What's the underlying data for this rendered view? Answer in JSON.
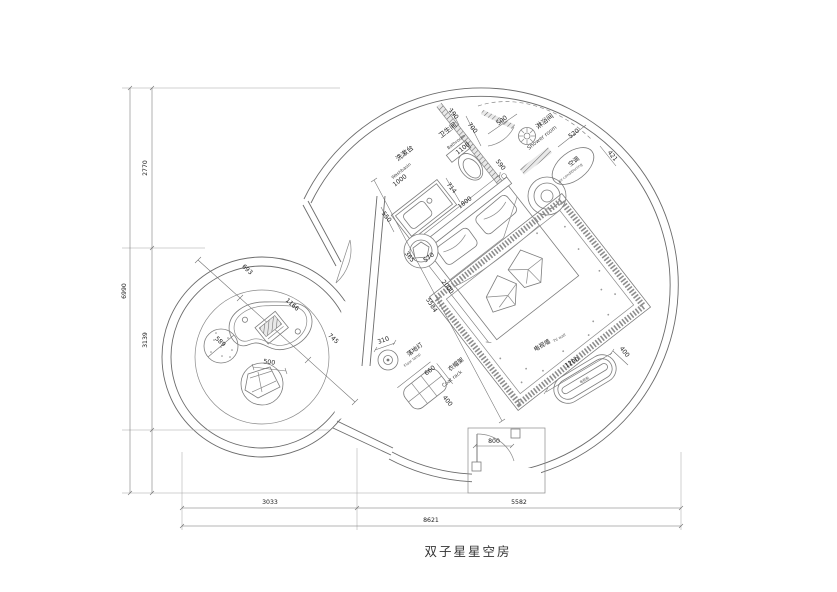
{
  "title": "双子星星空房",
  "labels": {
    "washbasin_cn": "洗漱台",
    "washbasin_en": "Washbasin",
    "bathroom_cn": "卫生间",
    "bathroom_en": "Bathroom",
    "shower_cn": "淋浴间",
    "shower_en": "Shower room",
    "ac_cn": "空调",
    "ac_en": "air-conditioning",
    "tv_wall_cn": "电视墙",
    "tv_wall_en": "TV wall",
    "tv_cabinet_cn": "电视柜",
    "floor_lamp_cn": "落地灯",
    "floor_lamp_en": "Floor lamp",
    "coat_rack_cn": "衣帽架",
    "coat_rack_en": "Coat rack"
  },
  "dims": {
    "washbasin": "1000",
    "bathroom": "1100",
    "wall_190": "190",
    "door_700": "700",
    "door_500": "500",
    "toilet_590": "590",
    "shower_520": "520",
    "ac_421": "421",
    "basin_714": "714",
    "bed_width": "1800",
    "bed_length": "2000",
    "counter_550": "550",
    "stool_365": "365",
    "stool_570": "570",
    "room_diag": "5584",
    "lamp_310": "310",
    "rack_660": "660",
    "rack_400": "400",
    "tv_1200": "1200",
    "tv_400": "400",
    "entry_800": "800",
    "left_693": "693",
    "left_1166": "1166",
    "left_745": "745",
    "beanbag_589": "589",
    "chair_500": "500",
    "v_2770": "2770",
    "v_3139": "3139",
    "v_6990": "6990",
    "h_3033": "3033",
    "h_5582": "5582",
    "h_8621": "8621"
  }
}
